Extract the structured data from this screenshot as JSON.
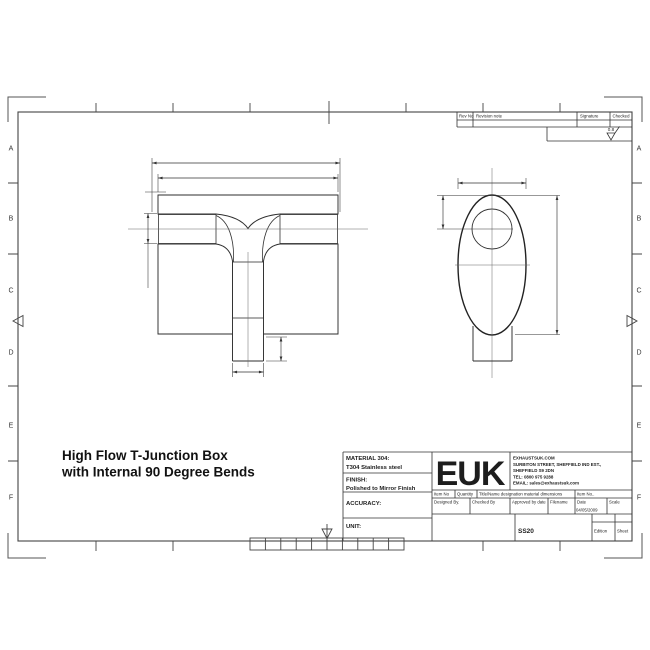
{
  "sheet": {
    "zone_letters": [
      "A",
      "B",
      "C",
      "D",
      "E",
      "F"
    ]
  },
  "drawing_title": {
    "line1": "High Flow T-Junction Box",
    "line2": "with Internal 90 Degree Bends"
  },
  "revision_table": {
    "rev_no": "Rev No",
    "revision_note": "Revision note",
    "signature": "Signature",
    "checked": "Checked",
    "surface_finish": "0.8"
  },
  "title_block": {
    "material_label": "MATERIAL 304:",
    "material_value": "T304 Stainless steel",
    "finish_label": "FINISH:",
    "finish_value": "Polished to Mirror Finish",
    "accuracy_label": "ACCURACY:",
    "unit_label": "UNIT:",
    "logo": "EUK",
    "company": {
      "website": "EXHAUSTSUK.COM",
      "address_line1": "SURBITON STREET, SHEFFIELD IND EST.,",
      "address_line2": "SHEFFIELD S9 2DN",
      "tel": "TEL: 0800 975 9288",
      "email": "EMAIL: sales@exhaustsuk.com"
    },
    "row1_headers": [
      "Item No",
      "Quantity",
      "Title/Name designation material dimensions",
      "Item No.."
    ],
    "row2_headers": [
      "Designed By.",
      "Checked By",
      "Approved by date",
      "Filename",
      "Date",
      "Scale"
    ],
    "date_value": "04/05/2009",
    "part_number": "SS20",
    "edition_label": "Edition",
    "sheet_label": "Sheet"
  }
}
